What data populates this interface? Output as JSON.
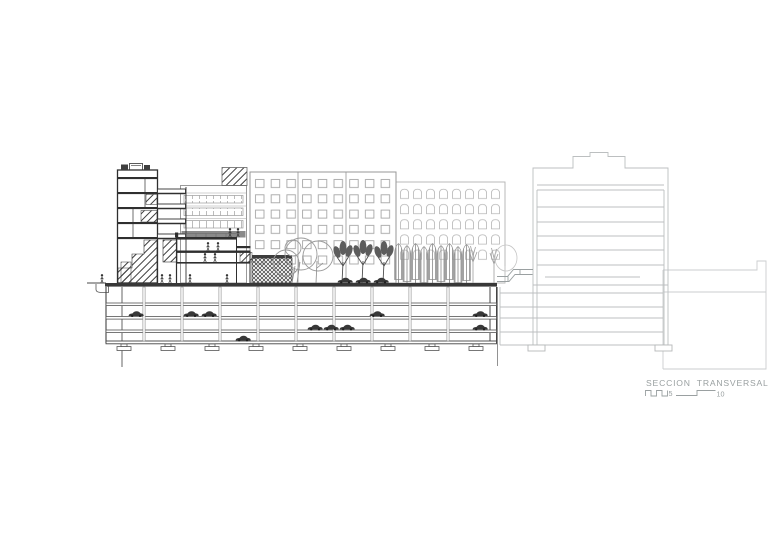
{
  "page": {
    "background": "#ffffff"
  },
  "title_block": {
    "title": "SECCION TRANSVERSAL",
    "scale_label_5": "5",
    "scale_label_10": "10"
  },
  "palette": {
    "section_dark": "#2f2f2f",
    "hatch_dark": "#3d3d3d",
    "elevation_medium": "#8f8f8f",
    "elevation_light": "#b2b2b2",
    "neighbor_light": "#bcbfc0",
    "boundary_light": "#cbcecf",
    "annotation_gray": "#9aa0a1",
    "car_color": "#383838"
  },
  "sprites": {
    "parking_cars": [
      [
        128,
        310
      ],
      [
        183,
        310
      ],
      [
        201,
        310
      ],
      [
        235,
        334.5
      ],
      [
        307,
        323.5
      ],
      [
        323,
        323.5
      ],
      [
        339,
        323.5
      ],
      [
        369,
        310
      ],
      [
        472,
        310
      ],
      [
        472,
        323.5
      ]
    ],
    "street_cars": [
      [
        337,
        276.5
      ],
      [
        355,
        276.5
      ],
      [
        373,
        276.5
      ]
    ],
    "people": [
      [
        100,
        274
      ],
      [
        160,
        274
      ],
      [
        168,
        274
      ],
      [
        188,
        274
      ],
      [
        225,
        274
      ],
      [
        206,
        242
      ],
      [
        216,
        242
      ],
      [
        203,
        253
      ],
      [
        213,
        253
      ],
      [
        228,
        228
      ],
      [
        236,
        228
      ]
    ],
    "cypress_trees": [
      [
        394,
        243
      ],
      [
        402.5,
        245
      ],
      [
        411,
        243
      ],
      [
        419.5,
        246
      ],
      [
        428,
        243
      ],
      [
        436.5,
        245
      ],
      [
        445,
        243
      ],
      [
        453.5,
        246
      ],
      [
        462,
        244
      ]
    ],
    "stick_trees": [
      [
        468,
        243
      ],
      [
        489,
        245
      ]
    ],
    "footings": [
      [
        117,
        344
      ],
      [
        161,
        344
      ],
      [
        205,
        344
      ],
      [
        249,
        344
      ],
      [
        293,
        344
      ],
      [
        337,
        344
      ],
      [
        381,
        344
      ],
      [
        425,
        344
      ],
      [
        469,
        344
      ]
    ]
  }
}
